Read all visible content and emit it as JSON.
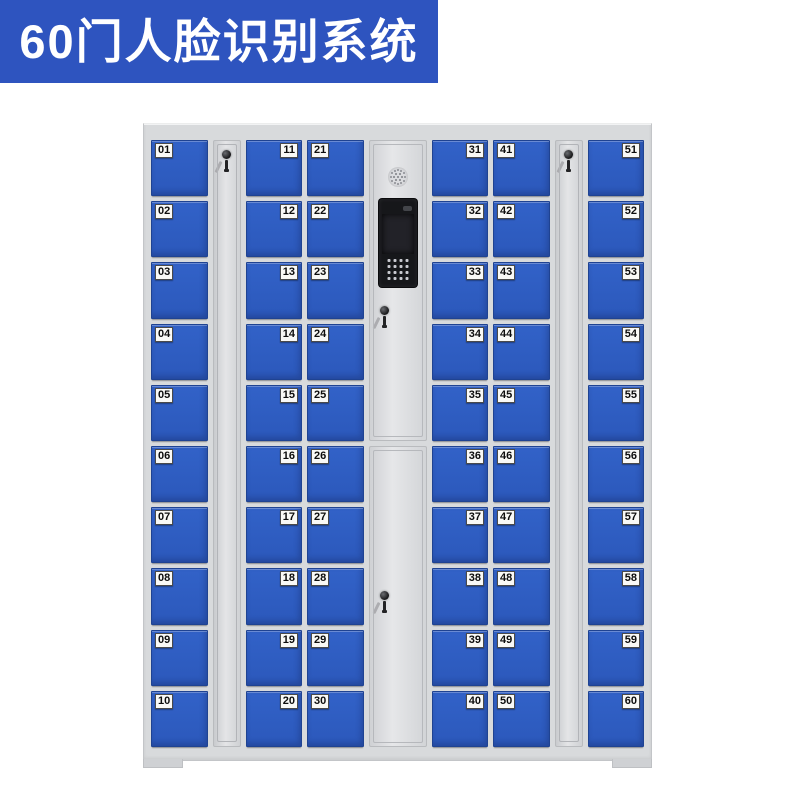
{
  "banner": {
    "title": "60门人脸识别系统",
    "bg_color": "#2e54bf",
    "text_color": "#ffffff"
  },
  "cabinet": {
    "frame_color": "#d8dadc",
    "door_color": "#3262c8",
    "door_count": 60,
    "icons": {
      "speaker": "speaker-grille-icon",
      "camera": "camera-lens-icon",
      "lock": "lock-keyhole-icon",
      "key": "key-icon"
    },
    "columns": [
      {
        "type": "doors",
        "label_side": "left",
        "doors": [
          "01",
          "02",
          "03",
          "04",
          "05",
          "06",
          "07",
          "08",
          "09",
          "10"
        ]
      },
      {
        "type": "lock-panel"
      },
      {
        "type": "doors",
        "label_side": "right",
        "doors": [
          "11",
          "12",
          "13",
          "14",
          "15",
          "16",
          "17",
          "18",
          "19",
          "20"
        ]
      },
      {
        "type": "doors",
        "label_side": "left",
        "doors": [
          "21",
          "22",
          "23",
          "24",
          "25",
          "26",
          "27",
          "28",
          "29",
          "30"
        ]
      },
      {
        "type": "control"
      },
      {
        "type": "doors",
        "label_side": "right",
        "doors": [
          "31",
          "32",
          "33",
          "34",
          "35",
          "36",
          "37",
          "38",
          "39",
          "40"
        ]
      },
      {
        "type": "doors",
        "label_side": "left",
        "doors": [
          "41",
          "42",
          "43",
          "44",
          "45",
          "46",
          "47",
          "48",
          "49",
          "50"
        ]
      },
      {
        "type": "lock-panel"
      },
      {
        "type": "doors",
        "label_side": "right",
        "doors": [
          "51",
          "52",
          "53",
          "54",
          "55",
          "56",
          "57",
          "58",
          "59",
          "60"
        ]
      }
    ]
  }
}
